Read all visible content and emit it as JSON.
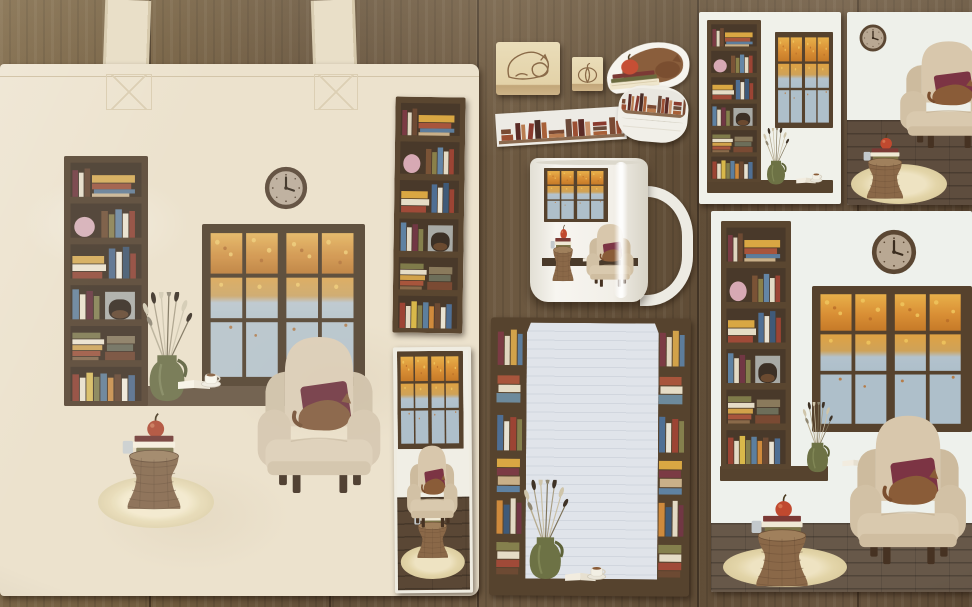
{
  "scene": {
    "description": "Flat-lay photograph of a cozy autumn reading-nook stationery collection arranged on a dark wooden plank floor",
    "surface": "dark wood planks",
    "items": [
      {
        "name": "canvas tote bag",
        "detail": "cream cotton tote printed with a reading-room illustration: tall bookshelf, wall clock, autumn window, dried-flower vase, teacup on open book, beige wingback armchair with maroon pillow and sleeping cat, wicker side table with books and apple on a cream rug"
      },
      {
        "name": "bookshelf bookmark",
        "detail": "tall dark-brown bookshelf strip print laid on the tote"
      },
      {
        "name": "armchair bookmark",
        "detail": "mini print of armchair by an autumn window with wicker table"
      },
      {
        "name": "rubber stamp large",
        "detail": "light wooden stamp engraved with a sleeping cat outline"
      },
      {
        "name": "rubber stamp small",
        "detail": "light wooden stamp engraved with a pumpkin outline"
      },
      {
        "name": "die-cut sticker",
        "detail": "brown cat sleeping on a stack of books with a red apple"
      },
      {
        "name": "washi tape strip",
        "detail": "strip of tape printed with rust and brown book spines"
      },
      {
        "name": "washi tape roll",
        "detail": "partially unrolled roll of the book-spine washi tape"
      },
      {
        "name": "ceramic mug",
        "detail": "white mug printed with dark window, wingback armchair and wicker basket"
      },
      {
        "name": "notepad",
        "detail": "notepad with bookshelf border frame, pale lined paper, lavender jug, teacup on open book"
      },
      {
        "name": "art print small",
        "detail": "print of bookshelf and autumn window with vase and teacup on the sill"
      },
      {
        "name": "art print cropped",
        "detail": "print of clock, armchair with cat and wicker table on wooden floor"
      },
      {
        "name": "art print large",
        "detail": "large print of the complete cozy reading nook illustration"
      }
    ],
    "palette": {
      "wood_floor": "#6a563c",
      "wood_seam": "#352416",
      "tote_canvas": "#ece2cd",
      "illustration_wall": "#eff1eb",
      "bookshelf_brown": "#5a4630",
      "window_frame": "#56422d",
      "autumn_orange": "#d98f35",
      "sky_blue": "#aebfca",
      "armchair_beige": "#d8c7ac",
      "pillow_maroon": "#7c3444",
      "cat_brown": "#8a5c38",
      "wicker_brown": "#8a6848",
      "rug_cream": "#eadfbd",
      "vase_olive": "#6d7245",
      "notepad_paper": "#e0e4ea",
      "stamp_wood": "#e6d7b0",
      "mug_white": "#f2efe8",
      "apple_red": "#c0492f"
    }
  }
}
